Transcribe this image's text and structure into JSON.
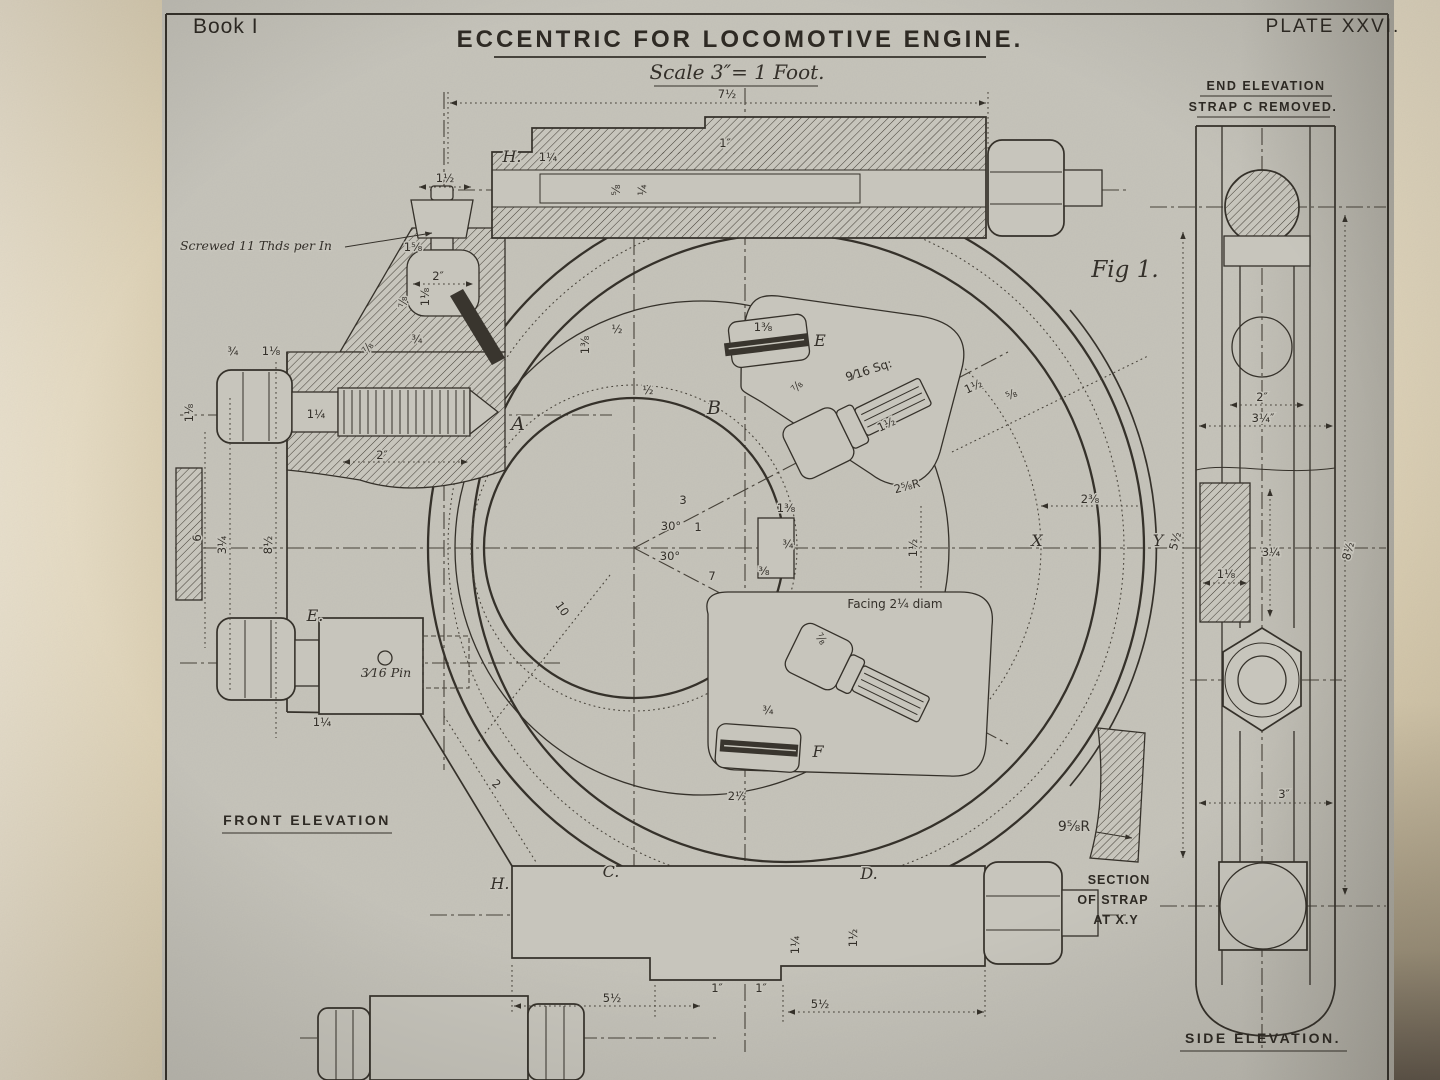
{
  "page": {
    "book_label": "Book I",
    "plate_label": "PLATE XXVI.",
    "title": "ECCENTRIC FOR LOCOMOTIVE ENGINE.",
    "scale_note": "Scale 3″= 1 Foot.",
    "fig_label": "Fig 1."
  },
  "view_titles": {
    "front_elevation": "FRONT ELEVATION",
    "end_elevation_line1": "END ELEVATION",
    "end_elevation_line2": "STRAP C REMOVED.",
    "side_elevation": "SIDE ELEVATION.",
    "section_note_line1": "SECTION",
    "section_note_line2": "OF STRAP",
    "section_note_line3": "AT X.Y"
  },
  "part_letters": [
    {
      "t": "A",
      "x": 518,
      "y": 430,
      "cls": "big"
    },
    {
      "t": "B",
      "x": 714,
      "y": 414,
      "cls": "big"
    },
    {
      "t": "C.",
      "x": 611,
      "y": 877
    },
    {
      "t": "D.",
      "x": 869,
      "y": 879
    },
    {
      "t": "E",
      "x": 820,
      "y": 346
    },
    {
      "t": "E.",
      "x": 315,
      "y": 621
    },
    {
      "t": "F",
      "x": 818,
      "y": 757
    },
    {
      "t": "H.",
      "x": 512,
      "y": 162
    },
    {
      "t": "H.",
      "x": 500,
      "y": 889
    },
    {
      "t": "X",
      "x": 1037,
      "y": 546
    },
    {
      "t": "Y",
      "x": 1158,
      "y": 546
    }
  ],
  "dimensions": [
    {
      "t": "7½",
      "x": 727,
      "y": 98
    },
    {
      "t": "1½",
      "x": 445,
      "y": 182
    },
    {
      "t": "1¼",
      "x": 548,
      "y": 161
    },
    {
      "t": "1″",
      "x": 725,
      "y": 147
    },
    {
      "t": "⅝",
      "x": 620,
      "y": 190,
      "r": -90
    },
    {
      "t": "¼",
      "x": 646,
      "y": 190,
      "r": -90
    },
    {
      "t": "1⅝",
      "x": 413,
      "y": 251
    },
    {
      "t": "2″",
      "x": 438,
      "y": 280
    },
    {
      "t": "⅞",
      "x": 407,
      "y": 302,
      "r": -90
    },
    {
      "t": "1⅛",
      "x": 429,
      "y": 297,
      "r": -90
    },
    {
      "t": "⅞",
      "x": 371,
      "y": 350,
      "r": -55
    },
    {
      "t": "¾",
      "x": 417,
      "y": 343
    },
    {
      "t": "¾",
      "x": 233,
      "y": 355
    },
    {
      "t": "1⅛",
      "x": 271,
      "y": 355
    },
    {
      "t": "1⅛",
      "x": 193,
      "y": 413,
      "r": -90
    },
    {
      "t": "1¼",
      "x": 316,
      "y": 418
    },
    {
      "t": "2″",
      "x": 382,
      "y": 459
    },
    {
      "t": "6",
      "x": 201,
      "y": 538,
      "r": -90
    },
    {
      "t": "3¼",
      "x": 226,
      "y": 545,
      "r": -90
    },
    {
      "t": "8½",
      "x": 272,
      "y": 545,
      "r": -90
    },
    {
      "t": "1¼",
      "x": 322,
      "y": 726
    },
    {
      "t": "½",
      "x": 617,
      "y": 333
    },
    {
      "t": "1⅜",
      "x": 589,
      "y": 345,
      "r": -90
    },
    {
      "t": "½",
      "x": 648,
      "y": 394
    },
    {
      "t": "1⅜",
      "x": 763,
      "y": 331
    },
    {
      "t": "⅞",
      "x": 800,
      "y": 389,
      "r": -50
    },
    {
      "t": "1½",
      "x": 888,
      "y": 428,
      "r": -25
    },
    {
      "t": "1½",
      "x": 975,
      "y": 390,
      "r": -25
    },
    {
      "t": "⅝",
      "x": 1013,
      "y": 398,
      "r": -25
    },
    {
      "t": "2⅝R",
      "x": 908,
      "y": 490,
      "r": -15
    },
    {
      "t": "3",
      "x": 683,
      "y": 504
    },
    {
      "t": "30°",
      "x": 671,
      "y": 530
    },
    {
      "t": "30°",
      "x": 670,
      "y": 560
    },
    {
      "t": "1",
      "x": 698,
      "y": 531
    },
    {
      "t": "1⅜",
      "x": 786,
      "y": 512
    },
    {
      "t": "¾",
      "x": 788,
      "y": 548
    },
    {
      "t": "⅜",
      "x": 764,
      "y": 575
    },
    {
      "t": "7",
      "x": 712,
      "y": 580
    },
    {
      "t": "10",
      "x": 559,
      "y": 611,
      "r": 55
    },
    {
      "t": "1½",
      "x": 917,
      "y": 548,
      "r": -90
    },
    {
      "t": "⅞",
      "x": 818,
      "y": 641,
      "r": 55
    },
    {
      "t": "¾",
      "x": 768,
      "y": 714
    },
    {
      "t": "2½",
      "x": 737,
      "y": 800
    },
    {
      "t": "2",
      "x": 494,
      "y": 787,
      "r": 40
    },
    {
      "t": "2⅜",
      "x": 1090,
      "y": 503
    },
    {
      "t": "5½",
      "x": 612,
      "y": 1002
    },
    {
      "t": "1″",
      "x": 717,
      "y": 992
    },
    {
      "t": "1″",
      "x": 761,
      "y": 992
    },
    {
      "t": "5½",
      "x": 820,
      "y": 1008
    },
    {
      "t": "1¼",
      "x": 799,
      "y": 945,
      "r": -90
    },
    {
      "t": "1½",
      "x": 857,
      "y": 938,
      "r": -90
    },
    {
      "t": "2″",
      "x": 1262,
      "y": 401
    },
    {
      "t": "3¼″",
      "x": 1263,
      "y": 422
    },
    {
      "t": "3¼",
      "x": 1271,
      "y": 556
    },
    {
      "t": "1⅛",
      "x": 1226,
      "y": 578
    },
    {
      "t": "3″",
      "x": 1284,
      "y": 798
    },
    {
      "t": "5½",
      "x": 1179,
      "y": 542,
      "r": -75
    },
    {
      "t": "8½",
      "x": 1352,
      "y": 552,
      "r": -75
    }
  ],
  "notes": [
    {
      "t": "Screwed 11 Thds per In",
      "x": 256,
      "y": 250
    },
    {
      "t": "3⁄16 Pin",
      "x": 386,
      "y": 677
    },
    {
      "t": "Facing 2¼ diam",
      "x": 895,
      "y": 608,
      "cls": "plain"
    },
    {
      "t": "9⁄16 Sq:",
      "x": 870,
      "y": 374,
      "r": -18,
      "cls": "plain"
    },
    {
      "t": "9⅝R",
      "x": 1074,
      "y": 831,
      "cls": "plain14"
    }
  ],
  "colors": {
    "paper": "#c7c5bc",
    "ink": "#35312a",
    "margin_paper": "#eae0c9",
    "shadow": "#6b6151"
  }
}
